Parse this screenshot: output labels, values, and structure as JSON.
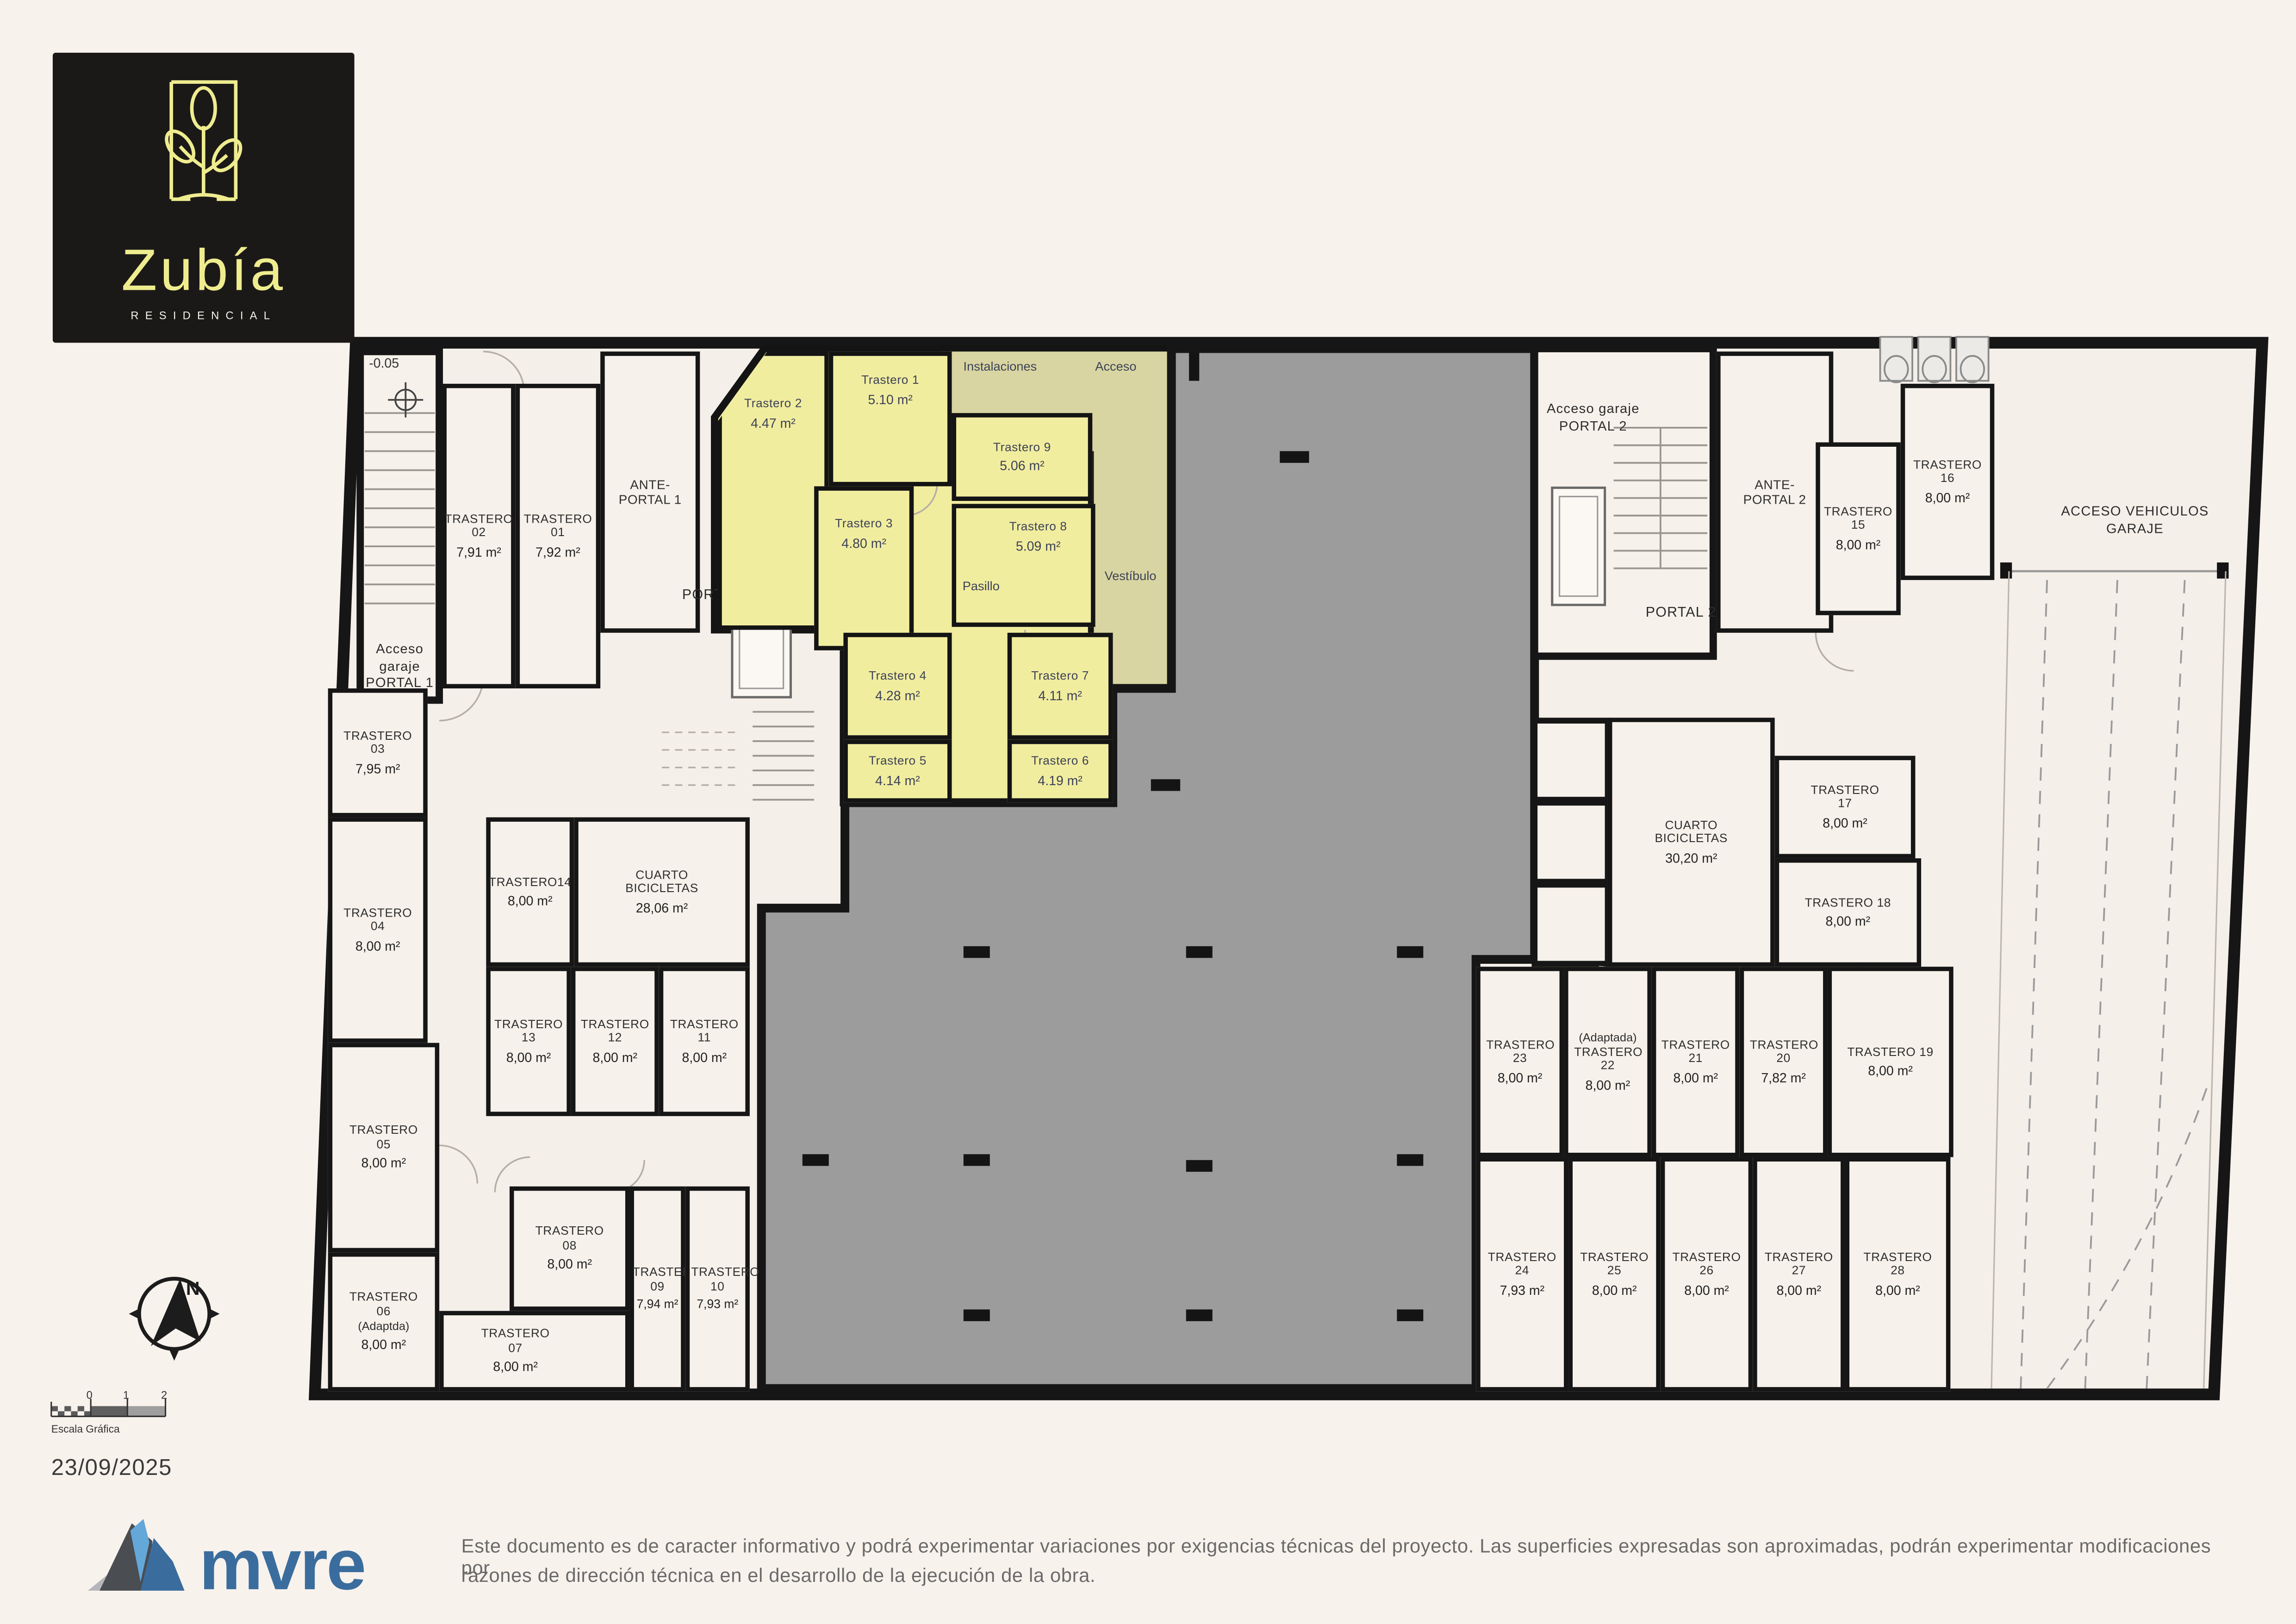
{
  "branding": {
    "name": "Zubía",
    "subtitle": "RESIDENCIAL",
    "company": "mvre"
  },
  "plan": {
    "level_marker": "-0.05",
    "left_wing": {
      "commons": {
        "acceso_garaje": "Acceso garaje PORTAL 1",
        "ante_portal": "ANTE-PORTAL 1",
        "portal": "PORTAL 1",
        "cuarto_bicicletas": {
          "name": "CUARTO BICICLETAS",
          "area": "28,06 m²"
        }
      },
      "rooms": [
        {
          "name": "TRASTERO 02",
          "area": "7,91 m²"
        },
        {
          "name": "TRASTERO 01",
          "area": "7,92 m²"
        },
        {
          "name": "TRASTERO 03",
          "area": "7,95 m²"
        },
        {
          "name": "TRASTERO 04",
          "area": "8,00 m²"
        },
        {
          "name": "TRASTERO14",
          "area": "8,00 m²"
        },
        {
          "name": "TRASTERO 13",
          "area": "8,00 m²"
        },
        {
          "name": "TRASTERO 12",
          "area": "8,00 m²"
        },
        {
          "name": "TRASTERO 11",
          "area": "8,00 m²"
        },
        {
          "name": "TRASTERO 05",
          "area": "8,00 m²"
        },
        {
          "name": "TRASTERO 08",
          "area": "8,00 m²"
        },
        {
          "name": "TRASTERO 09",
          "area": "7,94 m²"
        },
        {
          "name": "TRASTERO 10",
          "area": "7,93 m²"
        },
        {
          "name": "TRASTERO 06",
          "note": "(Adaptda)",
          "area": "8,00 m²"
        },
        {
          "name": "TRASTERO 07",
          "area": "8,00 m²"
        }
      ]
    },
    "highlight_zone": {
      "labels": {
        "instalaciones": "Instalaciones",
        "acceso": "Acceso",
        "pasillo": "Pasillo",
        "vestibulo": "Vestíbulo"
      },
      "rooms": [
        {
          "name": "Trastero 1",
          "area": "5.10 m²"
        },
        {
          "name": "Trastero 2",
          "area": "4.47 m²"
        },
        {
          "name": "Trastero 3",
          "area": "4.80 m²"
        },
        {
          "name": "Trastero 4",
          "area": "4.28 m²"
        },
        {
          "name": "Trastero 5",
          "area": "4.14 m²"
        },
        {
          "name": "Trastero 6",
          "area": "4.19 m²"
        },
        {
          "name": "Trastero 7",
          "area": "4.11 m²"
        },
        {
          "name": "Trastero 8",
          "area": "5.09 m²"
        },
        {
          "name": "Trastero 9",
          "area": "5.06 m²"
        }
      ]
    },
    "right_wing": {
      "commons": {
        "acceso_garaje": "Acceso garaje PORTAL 2",
        "ante_portal": "ANTE-PORTAL 2",
        "portal": "PORTAL 2",
        "cuarto_bicicletas": {
          "name": "CUARTO BICICLETAS",
          "area": "30,20 m²"
        },
        "acceso_vehiculos": "ACCESO VEHICULOS GARAJE"
      },
      "rooms": [
        {
          "name": "TRASTERO 16",
          "area": "8,00 m²"
        },
        {
          "name": "TRASTERO 15",
          "area": "8,00 m²"
        },
        {
          "name": "TRASTERO 17",
          "area": "8,00 m²"
        },
        {
          "name": "TRASTERO 18",
          "area": "8,00 m²"
        },
        {
          "name": "TRASTERO 23",
          "area": "8,00 m²"
        },
        {
          "name": "TRASTERO 22",
          "note": "(Adaptada)",
          "area": "8,00 m²"
        },
        {
          "name": "TRASTERO 21",
          "area": "8,00 m²"
        },
        {
          "name": "TRASTERO 20",
          "area": "7,82 m²"
        },
        {
          "name": "TRASTERO 19",
          "area": "8,00 m²"
        },
        {
          "name": "TRASTERO 24",
          "area": "7,93 m²"
        },
        {
          "name": "TRASTERO 25",
          "area": "8,00 m²"
        },
        {
          "name": "TRASTERO 26",
          "area": "8,00 m²"
        },
        {
          "name": "TRASTERO 27",
          "area": "8,00 m²"
        },
        {
          "name": "TRASTERO 28",
          "area": "8,00 m²"
        }
      ]
    }
  },
  "footer": {
    "compass_label": "N",
    "scale_caption": "Escala Gráfica",
    "scale_ticks": [
      "0",
      "1",
      "2"
    ],
    "date": "23/09/2025",
    "disclaimer_line1": "Este documento es de caracter informativo y podrá experimentar variaciones por exigencias técnicas del proyecto. Las superficies expresadas son aproximadas, podrán experimentar modificaciones por",
    "disclaimer_line2": "razones de dirección técnica en el desarrollo de la ejecución de la obra."
  },
  "colors": {
    "highlight_yellow": "#f1ed9f",
    "common_olive": "#d9d5a2",
    "garage_gray": "#9c9c9c",
    "wall_black": "#161616",
    "logo_accent": "#efec8f",
    "brand_blue": "#3a6d9e"
  }
}
